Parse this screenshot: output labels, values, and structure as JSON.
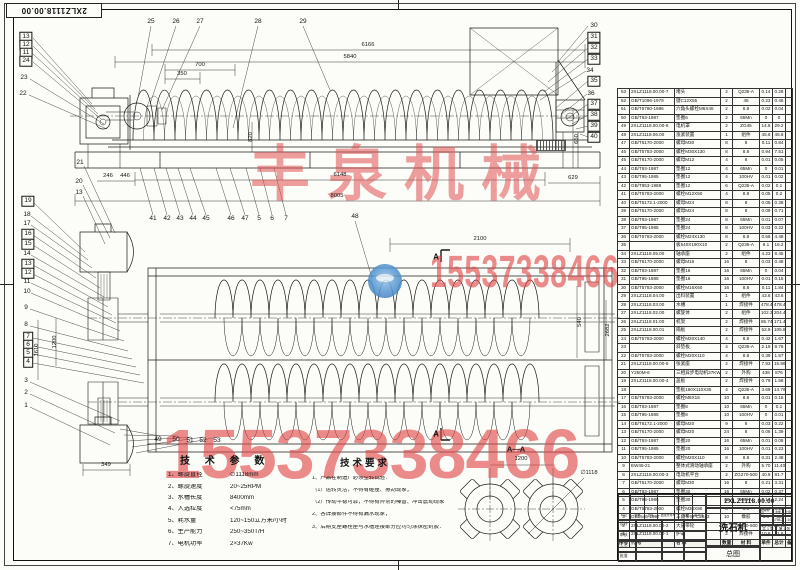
{
  "sheet": {
    "code": "2XLZ1118.00.00",
    "product_name": "洗石机",
    "drawing_type": "总图"
  },
  "watermarks": {
    "company": "丰泉机械",
    "phone": "15537338466",
    "color": "#e05050"
  },
  "tech_params": {
    "heading": "技 术 参 数",
    "items": [
      {
        "label": "1、螺旋直径",
        "value": "∅1118mm"
      },
      {
        "label": "2、螺旋速度",
        "value": "20~25RPM"
      },
      {
        "label": "3、水槽长度",
        "value": "8400mm"
      },
      {
        "label": "4、入选粒度",
        "value": "<75mm"
      },
      {
        "label": "5、耗水量",
        "value": "120~150立方米/小时"
      },
      {
        "label": "6、生产能力",
        "value": "250~350T/H"
      },
      {
        "label": "7、电机功率",
        "value": "2×37Kw"
      }
    ]
  },
  "tech_requirements": {
    "heading": "技术要求",
    "lines": [
      "1、产品在制造厂必须空转试验：",
      "（1）运转灵活，不得有碰撞、擦刮现象；",
      "（2）传动平稳可靠，不得有异常的噪音、冲击震动现象",
      "2、各焊接部件不得有漏水现象；",
      "3、后期支座螺栓座与水槽连接部分应均匀涂抹密封胶："
    ]
  },
  "section_view": {
    "label": "A—A",
    "cut_label": "A",
    "dim_centers": "1200",
    "dim_diameter": "∅1118"
  },
  "bom": {
    "headers": [
      "序号",
      "代  号",
      "名  称",
      "数量",
      "材  料",
      "单件",
      "总计",
      "备注"
    ],
    "rows": [
      [
        "53",
        "2XLZ1118.00.00-7",
        "堵头",
        "2",
        "Q235-A",
        "0.14",
        "0.28",
        ""
      ],
      [
        "52",
        "GB/T1096-1979",
        "键C12X55",
        "2",
        "45",
        "0.23",
        "0.46",
        ""
      ],
      [
        "51",
        "GB/T5780-1986",
        "六角头螺栓M6X45",
        "2",
        "8.8",
        "0.02",
        "0.04",
        ""
      ],
      [
        "50",
        "GB/T93-1987",
        "垫圈6",
        "2",
        "65Mn",
        "0",
        "0",
        ""
      ],
      [
        "49",
        "2XLZ1118.00.00-6",
        "电机罩",
        "2",
        "ZG45",
        "14.6",
        "29.2",
        ""
      ],
      [
        "48",
        "2XLZ1118.06.00",
        "涨紧装置",
        "1",
        "组件",
        "45.6",
        "45.6",
        ""
      ],
      [
        "47",
        "GB/T6170-2000",
        "螺母M30",
        "8",
        "8",
        "0.11",
        "0.84",
        ""
      ],
      [
        "46",
        "GB/T5783-2000",
        "螺栓M30X130",
        "8",
        "8.8",
        "0.94",
        "7.51",
        ""
      ],
      [
        "45",
        "GB/T6170-2000",
        "螺母M12",
        "4",
        "8",
        "0.01",
        "0.05",
        ""
      ],
      [
        "44",
        "GB/T93-1987",
        "垫圈12",
        "4",
        "65Mn",
        "0",
        "0.01",
        ""
      ],
      [
        "43",
        "GB/T95-1985",
        "垫圈12",
        "4",
        "100HV",
        "0.01",
        "0.02",
        ""
      ],
      [
        "42",
        "GB/T853-1988",
        "垫圈12",
        "6",
        "Q235-A",
        "0.02",
        "0.1",
        ""
      ],
      [
        "41",
        "GB/T5783-2000",
        "螺栓M12X50",
        "4",
        "8.8",
        "0.05",
        "0.2",
        ""
      ],
      [
        "40",
        "GB/T6172.1-2000",
        "螺母M24",
        "8",
        "8",
        "0.05",
        "0.38",
        ""
      ],
      [
        "39",
        "GB/T6170-2000",
        "螺母M24",
        "8",
        "8",
        "0.09",
        "0.71",
        ""
      ],
      [
        "38",
        "GB/T93-1987",
        "垫圈24",
        "8",
        "65Mn",
        "0.01",
        "0.07",
        ""
      ],
      [
        "37",
        "GB/T95-1985",
        "垫圈24",
        "8",
        "100HV",
        "0.03",
        "0.22",
        ""
      ],
      [
        "36",
        "GB/T5783-2000",
        "螺栓M24X130",
        "8",
        "8.8",
        "0.56",
        "4.48",
        ""
      ],
      [
        "35",
        "",
        "板540X190X10",
        "2",
        "Q235-A",
        "8.1",
        "16.2",
        ""
      ],
      [
        "34",
        "2XLZ1118.05.00",
        "轴承座",
        "2",
        "组件",
        "4.23",
        "8.45",
        ""
      ],
      [
        "33",
        "GB/T6170-2000",
        "螺母M16",
        "16",
        "8",
        "0.03",
        "0.48",
        ""
      ],
      [
        "32",
        "GB/T93-1987",
        "垫圈16",
        "16",
        "65Mn",
        "0",
        "0.04",
        ""
      ],
      [
        "31",
        "GB/T95-1985",
        "垫圈16",
        "16",
        "100HV",
        "0.01",
        "0.15",
        ""
      ],
      [
        "30",
        "GB/T5783-2000",
        "螺栓M16X60",
        "16",
        "8.8",
        "0.11",
        "1.84",
        ""
      ],
      [
        "29",
        "2XLZ1118.04.00",
        "出料装置",
        "1",
        "组件",
        "43.6",
        "43.6",
        ""
      ],
      [
        "28",
        "2XLZ1118.03.00",
        "水槽",
        "1",
        "焊接件",
        "478.4",
        "478.4",
        ""
      ],
      [
        "27",
        "2XLZ1118.02.00",
        "螺旋体",
        "2",
        "组件",
        "102.2",
        "204.4",
        ""
      ],
      [
        "26",
        "2XLZ1118.01.00",
        "机架",
        "2",
        "焊接件",
        "85.74",
        "171.48",
        ""
      ],
      [
        "25",
        "2XLZ1118.00.01",
        "隔板",
        "2",
        "焊接件",
        "52.9",
        "105.8",
        ""
      ],
      [
        "24",
        "GB/T5783-2000",
        "螺栓M20X140",
        "4",
        "8.8",
        "0.42",
        "1.67",
        ""
      ],
      [
        "23",
        "",
        "斜垫板",
        "4",
        "Q235-A",
        "2.19",
        "8.76",
        ""
      ],
      [
        "22",
        "GB/T5783-2000",
        "螺栓M20X110",
        "4",
        "8.8",
        "0.39",
        "1.57",
        ""
      ],
      [
        "21",
        "2XLZ1118.00.00-5",
        "张紧座",
        "2",
        "焊接件",
        "7.93",
        "15.86",
        ""
      ],
      [
        "20",
        "Y250M-6",
        "三相异步电动机37KW",
        "2",
        "外购",
        "438",
        "876",
        ""
      ],
      [
        "19",
        "2XLZ1118.00.00-4",
        "盖板",
        "2",
        "焊接件",
        "0.79",
        "1.58",
        ""
      ],
      [
        "18",
        "",
        "垫板160X110X35",
        "4",
        "Q235-A",
        "3.69",
        "14.76",
        ""
      ],
      [
        "17",
        "GB/T5783-2000",
        "螺栓M8X16",
        "10",
        "8.8",
        "0.01",
        "0.15",
        ""
      ],
      [
        "16",
        "GB/T93-1987",
        "垫圈8",
        "10",
        "65Mn",
        "0",
        "0.1",
        ""
      ],
      [
        "15",
        "GB/T95-1985",
        "垫圈8",
        "10",
        "100HV",
        "0",
        "0.01",
        ""
      ],
      [
        "14",
        "GB/T6172.1-2000",
        "螺母M20",
        "9",
        "8",
        "0.03",
        "0.22",
        ""
      ],
      [
        "13",
        "GB/T6170-2000",
        "螺母M20",
        "24",
        "8",
        "0.06",
        "1.39",
        ""
      ],
      [
        "12",
        "GB/T93-1987",
        "垫圈20",
        "16",
        "65Mn",
        "0.01",
        "0.08",
        ""
      ],
      [
        "11",
        "GB/T95-1985",
        "垫圈20",
        "16",
        "100HV",
        "0.01",
        "0.23",
        ""
      ],
      [
        "10",
        "GB/T5783-2000",
        "螺栓M20X110",
        "8",
        "8.8",
        "0.31",
        "2.48",
        ""
      ],
      [
        "9",
        "EW45-21",
        "整体式滑动轴承座",
        "2",
        "外购",
        "5.70",
        "11.40",
        ""
      ],
      [
        "8",
        "2XLZ1118.00.00-3",
        "电动机平台",
        "2",
        "ZG270-500",
        "40.9",
        "81.7",
        ""
      ],
      [
        "7",
        "GB/T6170-2000",
        "螺母M30",
        "16",
        "8",
        "0.21",
        "3.31",
        ""
      ],
      [
        "6",
        "GB/T93-1987",
        "垫圈30",
        "16",
        "65Mn",
        "0.02",
        "0.37",
        ""
      ],
      [
        "5",
        "GB/T95-1985",
        "垫圈30",
        "16",
        "100HV",
        "0.14",
        "2.24",
        ""
      ],
      [
        "4",
        "GB/T5783-2000",
        "螺栓M30X90",
        "8",
        "8.8",
        "0.65",
        "5.22",
        ""
      ],
      [
        "3",
        "GB1546-1997",
        "三角带SPC2843",
        "10",
        "橡胶",
        "3.5",
        "35",
        ""
      ],
      [
        "2",
        "2XLZ1118.00.00-2",
        "大皮带轮",
        "2",
        "ZG270-500",
        "14.59",
        "29.18",
        ""
      ],
      [
        "1",
        "2XLZ1118.00.00-1",
        "护罩",
        "2",
        "焊接件",
        "10.8",
        "21.6",
        ""
      ]
    ]
  },
  "title_block": {
    "rev_labels": [
      "标记",
      "处数",
      "分区",
      "更改文件号",
      "签名",
      "年月日"
    ],
    "sign_labels": [
      "设计",
      "审核",
      "工艺",
      "批准"
    ],
    "stage_label": "阶段标记",
    "weight_label": "重量",
    "scale_label": "比例",
    "weight_value": "1798.2",
    "scale_value": "1:10",
    "sheet_count": "共 1 张",
    "sheet_index": "第 1 张",
    "product_name": "洗石机",
    "code": "2XLZ1118.00.00",
    "drawing_type": "总图"
  },
  "callouts": [
    [
      13,
      26,
      37,
      1
    ],
    [
      12,
      26,
      45,
      1
    ],
    [
      11,
      26,
      53,
      1
    ],
    [
      24,
      26,
      61,
      1
    ],
    [
      23,
      24,
      78,
      0
    ],
    [
      22,
      23,
      94,
      0
    ],
    [
      25,
      151,
      22,
      0
    ],
    [
      26,
      176,
      22,
      0
    ],
    [
      27,
      200,
      22,
      0
    ],
    [
      28,
      258,
      22,
      0
    ],
    [
      29,
      303,
      22,
      0
    ],
    [
      30,
      594,
      26,
      0
    ],
    [
      31,
      594,
      37,
      1
    ],
    [
      32,
      594,
      48,
      1
    ],
    [
      33,
      594,
      59,
      1
    ],
    [
      34,
      590,
      71,
      0
    ],
    [
      35,
      594,
      81,
      1
    ],
    [
      36,
      591,
      94,
      0
    ],
    [
      37,
      594,
      104,
      1
    ],
    [
      38,
      594,
      115,
      1
    ],
    [
      39,
      594,
      126,
      1
    ],
    [
      40,
      594,
      137,
      1
    ],
    [
      41,
      153,
      219,
      0
    ],
    [
      42,
      167,
      219,
      0
    ],
    [
      43,
      180,
      219,
      0
    ],
    [
      44,
      193,
      219,
      0
    ],
    [
      45,
      206,
      219,
      0
    ],
    [
      46,
      231,
      219,
      0
    ],
    [
      47,
      245,
      219,
      0
    ],
    [
      5,
      259,
      219,
      0
    ],
    [
      6,
      272,
      219,
      0
    ],
    [
      7,
      286,
      219,
      0
    ],
    [
      21,
      80,
      163,
      0
    ],
    [
      20,
      79,
      182,
      0
    ],
    [
      13,
      79,
      193,
      0
    ],
    [
      19,
      28,
      201,
      1
    ],
    [
      18,
      27,
      215,
      0
    ],
    [
      17,
      27,
      224,
      0
    ],
    [
      16,
      28,
      234,
      1
    ],
    [
      15,
      28,
      244,
      1
    ],
    [
      14,
      27,
      254,
      0
    ],
    [
      13,
      28,
      264,
      1
    ],
    [
      12,
      28,
      273,
      1
    ],
    [
      11,
      27,
      282,
      0
    ],
    [
      10,
      27,
      292,
      0
    ],
    [
      9,
      26,
      308,
      0
    ],
    [
      8,
      26,
      325,
      0
    ],
    [
      7,
      28,
      337,
      1
    ],
    [
      6,
      28,
      345,
      1
    ],
    [
      5,
      28,
      353,
      1
    ],
    [
      4,
      28,
      362,
      1
    ],
    [
      3,
      26,
      381,
      0
    ],
    [
      2,
      26,
      393,
      0
    ],
    [
      1,
      26,
      406,
      0
    ],
    [
      48,
      355,
      217,
      0
    ],
    [
      49,
      158,
      440,
      0
    ],
    [
      50,
      176,
      440,
      0
    ],
    [
      51,
      190,
      441,
      0
    ],
    [
      52,
      203,
      441,
      0
    ],
    [
      53,
      217,
      441,
      0
    ]
  ],
  "dimensions": [
    {
      "t": "6166",
      "x": 368,
      "y": 46,
      "r": 0
    },
    {
      "t": "5840",
      "x": 350,
      "y": 58,
      "r": 0
    },
    {
      "t": "700",
      "x": 200,
      "y": 66,
      "r": 0
    },
    {
      "t": "350",
      "x": 182,
      "y": 75,
      "r": 0
    },
    {
      "t": "820",
      "x": 252,
      "y": 137,
      "r": 1
    },
    {
      "t": "246",
      "x": 108,
      "y": 177,
      "r": 0
    },
    {
      "t": "446",
      "x": 125,
      "y": 177,
      "r": 0
    },
    {
      "t": "6148",
      "x": 340,
      "y": 176,
      "r": 0
    },
    {
      "t": "629",
      "x": 573,
      "y": 179,
      "r": 0
    },
    {
      "t": "8005",
      "x": 337,
      "y": 197,
      "r": 0
    },
    {
      "t": "650",
      "x": 578,
      "y": 139,
      "r": 1
    },
    {
      "t": "2100",
      "x": 480,
      "y": 240,
      "r": 0
    },
    {
      "t": "349",
      "x": 106,
      "y": 466,
      "r": 0
    },
    {
      "t": "1610",
      "x": 38,
      "y": 350,
      "r": 1
    },
    {
      "t": "1200",
      "x": 56,
      "y": 342,
      "r": 1
    },
    {
      "t": "540",
      "x": 581,
      "y": 322,
      "r": 1
    },
    {
      "t": "2682",
      "x": 609,
      "y": 330,
      "r": 1
    },
    {
      "t": "1200",
      "x": 521,
      "y": 460,
      "r": 0
    },
    {
      "t": "∅1118",
      "x": 589,
      "y": 474,
      "r": 0
    }
  ]
}
